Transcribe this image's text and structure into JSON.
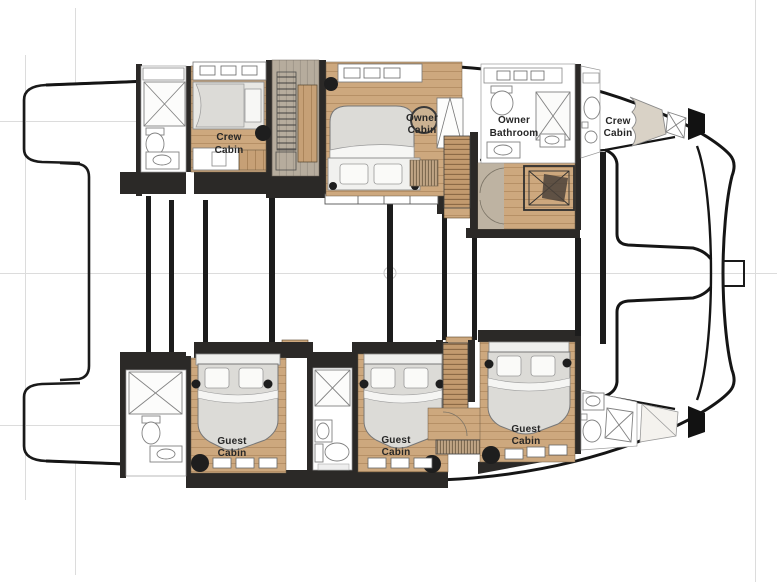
{
  "plan": {
    "type": "catamaran yacht lower deck floor plan",
    "orientation": "bow right, stern left"
  },
  "colors": {
    "background": "#ffffff",
    "hull_outline": "#1a1a1a",
    "wall": "#2b2927",
    "wood_floor": "#cda87e",
    "wood_dark": "#c29a6e",
    "corridor": "#b6ac9d",
    "mattress": "#dcdbd7",
    "fixture_stroke": "#7a7a7a",
    "construction_line": "#dcdcdc",
    "stool": "#1e1e1e"
  },
  "rooms": [
    {
      "id": "crew-cabin-port-aft",
      "label": "Crew Cabin",
      "lines": [
        "Crew",
        "Cabin"
      ]
    },
    {
      "id": "owner-cabin",
      "label": "Owner Cabin",
      "lines": [
        "Owner",
        "Cabin"
      ]
    },
    {
      "id": "owner-bathroom",
      "label": "Owner Bathroom",
      "lines": [
        "Owner",
        "Bathroom"
      ]
    },
    {
      "id": "crew-cabin-starboard-bow",
      "label": "Crew Cabin",
      "lines": [
        "Crew",
        "Cabin"
      ]
    },
    {
      "id": "guest-cabin-aft",
      "label": "Guest Cabin",
      "lines": [
        "Guest",
        "Cabin"
      ]
    },
    {
      "id": "guest-cabin-mid",
      "label": "Guest Cabin",
      "lines": [
        "Guest",
        "Cabin"
      ]
    },
    {
      "id": "guest-cabin-forward",
      "label": "Guest Cabin",
      "lines": [
        "Guest",
        "Cabin"
      ]
    }
  ]
}
